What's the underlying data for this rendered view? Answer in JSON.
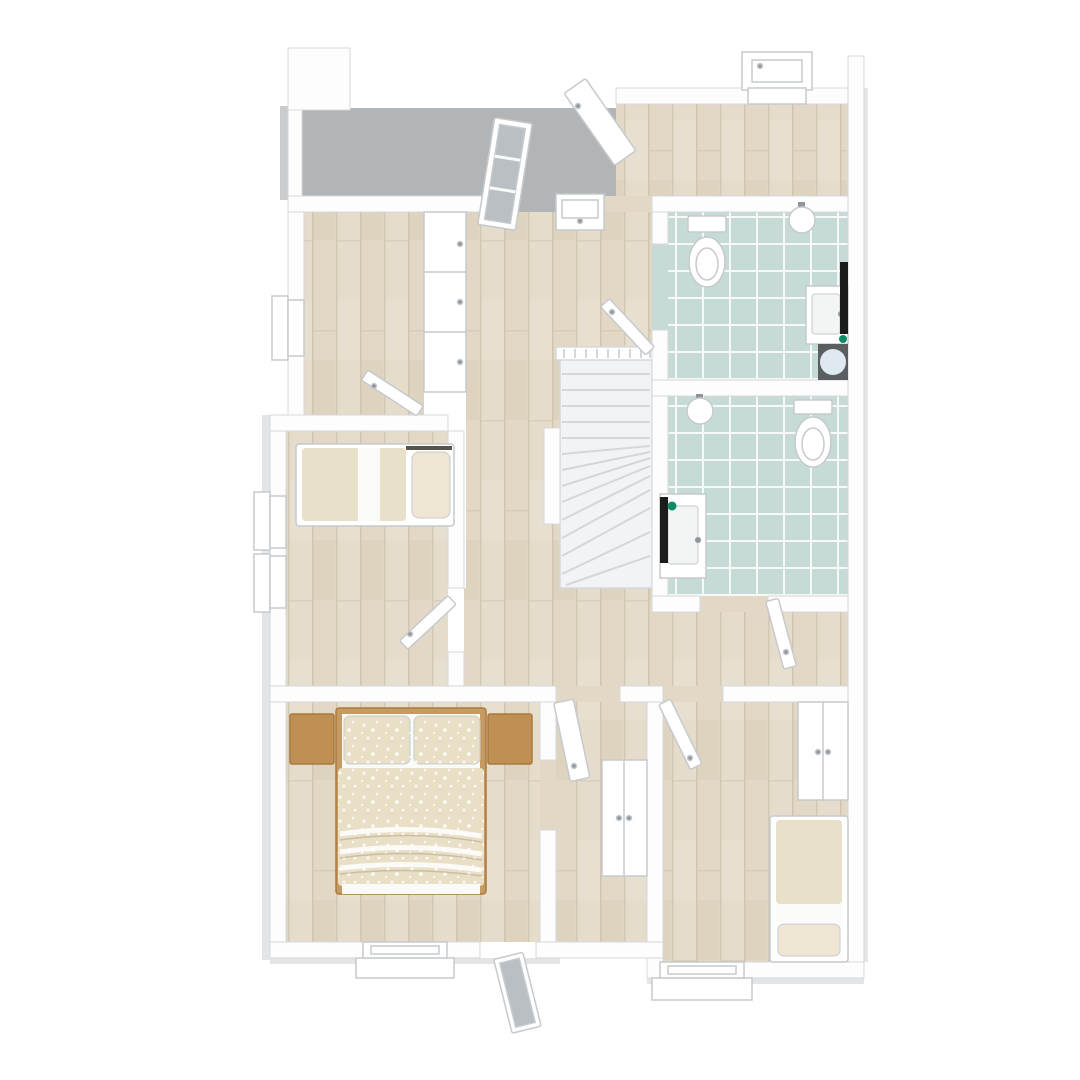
{
  "scene": {
    "description": "3D rendered top-down floor plan of an upper storey",
    "style": "photoreal-plan-render",
    "room_count": 10,
    "door_count": 9,
    "window_count": 7
  },
  "colors": {
    "background": "#ffffff",
    "wall": "#fdfdfd",
    "wall_edge": "#d5d8db",
    "wall_shadow": "#c9cccf",
    "outer_shadow": "#e3e5e6",
    "terrace_floor": "#b2b5b7",
    "wood_floor": "#e2d8c5",
    "tile_floor": "#c6dad6",
    "stair": "#f2f3f4",
    "stair_tread": "#d4d7da",
    "railing": "#ffffff",
    "mattress": "#e9e0c9",
    "pillow": "#eee6d2",
    "duvet": "#e8dfc6",
    "sheet": "#fafaf8",
    "bed_seam": "#57544a",
    "bed_frame_wood": "#c59a63",
    "nightstand_wood": "#c08f52",
    "nightstand_edge": "#a87a40",
    "fixture_white": "#ffffff",
    "fixture_edge": "#c6cacd",
    "basin_inner": "#f3f4f4",
    "radiator_black": "#1b1b1b",
    "accent_green": "#0e8a66",
    "shower_tray": "#5a5e61",
    "round_mat": "#dfeaf0",
    "glass": "#b9bfc2",
    "handle_gray": "#8f959a"
  },
  "rooms": [
    {
      "name": "terrace",
      "floor": "concrete-gray"
    },
    {
      "name": "landing",
      "floor": "wood"
    },
    {
      "name": "hallway",
      "floor": "wood"
    },
    {
      "name": "study",
      "floor": "wood"
    },
    {
      "name": "kids-bedroom",
      "floor": "wood"
    },
    {
      "name": "master-bedroom",
      "floor": "wood"
    },
    {
      "name": "bedroom-right",
      "floor": "wood"
    },
    {
      "name": "bathroom-top",
      "floor": "teal-tile"
    },
    {
      "name": "bathroom-middle",
      "floor": "teal-tile"
    },
    {
      "name": "stair-hall",
      "floor": "wood"
    }
  ],
  "fixtures": [
    "staircase",
    "stair-railing",
    "double-bed",
    "single-bed-kids",
    "single-bed-right",
    "nightstand-left",
    "nightstand-right",
    "hallway-closet",
    "hall-linen-closet",
    "wardrobe",
    "toilet-top",
    "toilet-middle",
    "corner-sink-top",
    "corner-sink-middle",
    "vanity-sink-top",
    "vanity-sink-middle",
    "towel-radiator-top",
    "towel-radiator-middle",
    "shower-tray",
    "round-mat",
    "entry-door",
    "glass-terrace-door",
    "french-door",
    "interior-doors",
    "windows"
  ]
}
